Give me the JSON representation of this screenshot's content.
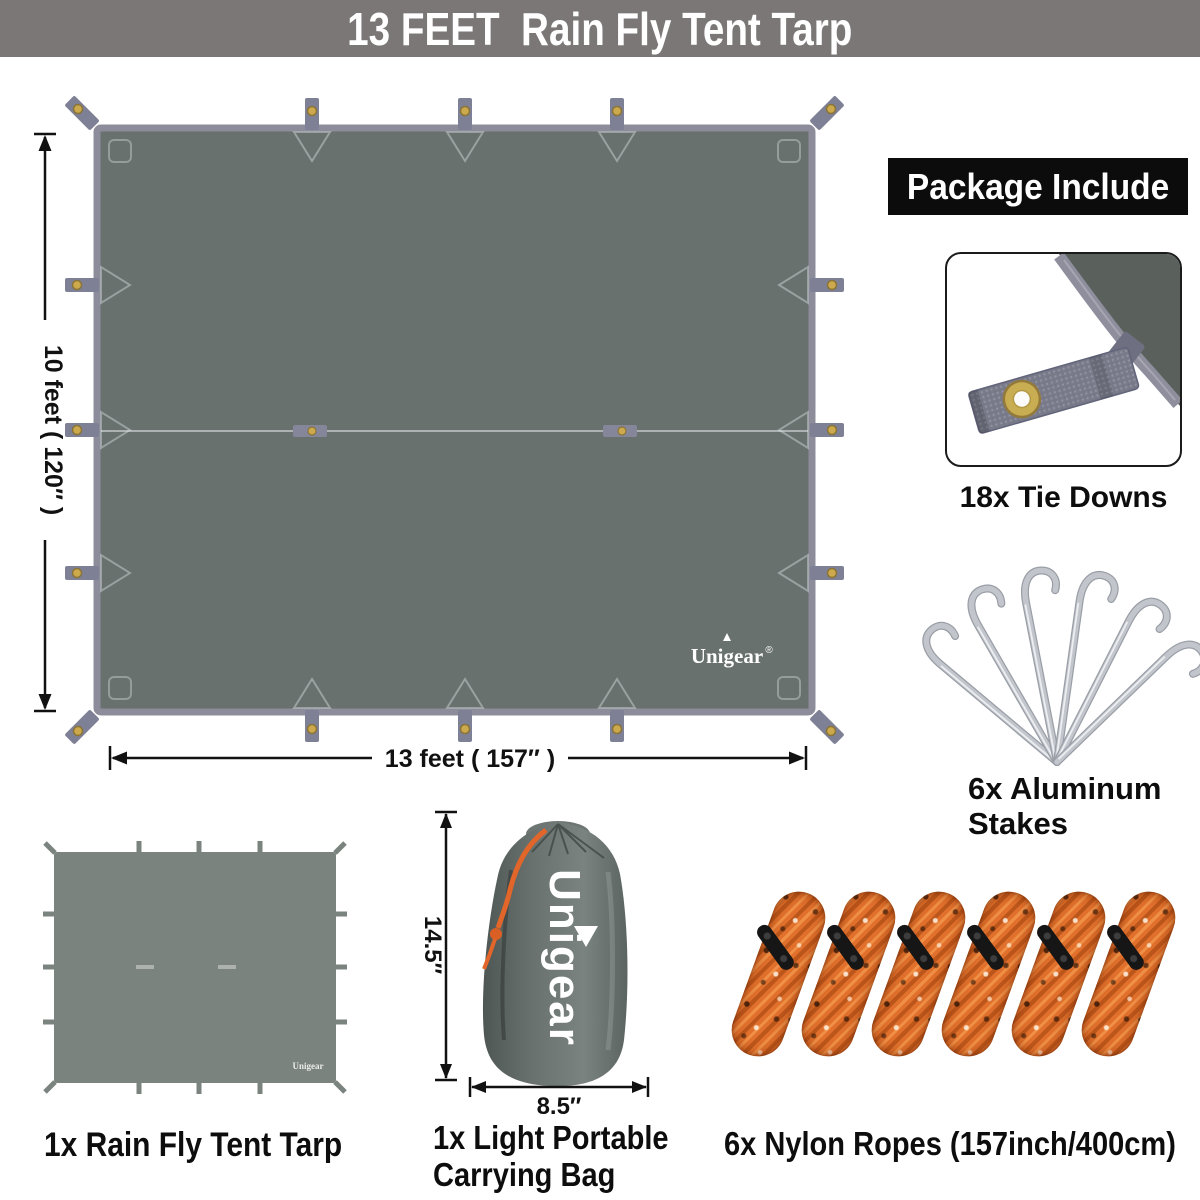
{
  "banner": {
    "title": "13 FEET  Rain Fly Tent Tarp"
  },
  "tarp": {
    "height_label": "10 feet ( 120″ )",
    "width_label": "13 feet ( 157″ )",
    "brand": "Unigear",
    "brand_reg": "®",
    "tie_down_count": 18
  },
  "package_include": {
    "header": "Package Include",
    "tie_downs_label": "18x Tie Downs",
    "stakes_label_line1": "6x Aluminum",
    "stakes_label_line2": "Stakes",
    "stakes_count": 6
  },
  "items": {
    "tarp_label": "1x Rain Fly Tent Tarp",
    "bag_label_line1": "1x Light Portable",
    "bag_label_line2": "Carrying Bag",
    "bag_height": "14.5″",
    "bag_width": "8.5″",
    "bag_brand": "Unigear",
    "mini_tarp_brand": "Unigear",
    "ropes_label": "6x Nylon Ropes (157inch/400cm)",
    "ropes_count": 6
  },
  "colors": {
    "banner_bg": "#7b7777",
    "tarp_fill": "#68716e",
    "tarp_border": "#8c8c9b",
    "grommet_brass": "#cda94d",
    "rope_orange": "#e0702c",
    "header_bg": "#0c0c0c",
    "text": "#0d0d0d"
  }
}
